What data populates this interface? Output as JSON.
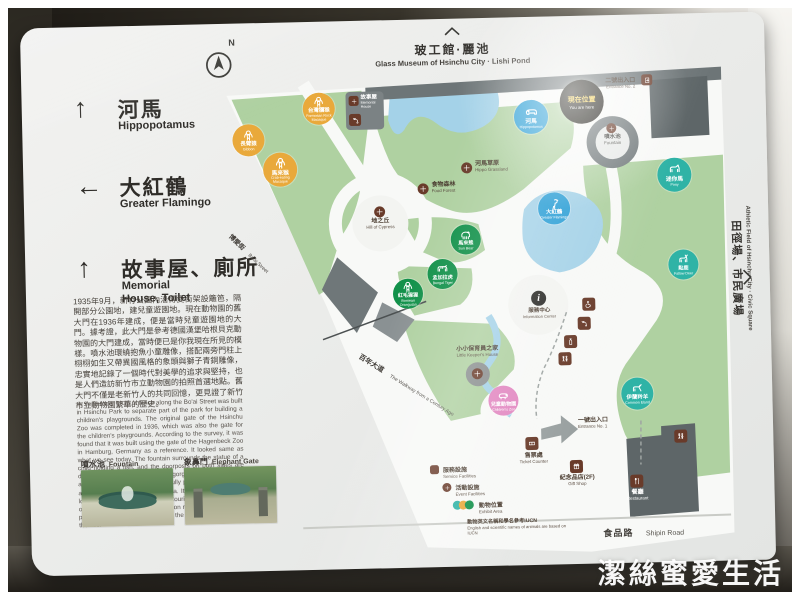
{
  "compass": {
    "label": "N"
  },
  "directions": [
    {
      "arrow": "↑",
      "zh": "河馬",
      "en": "Hippopotamus"
    },
    {
      "arrow": "←",
      "zh": "大紅鶴",
      "en": "Greater Flamingo"
    },
    {
      "arrow": "↑",
      "zh": "故事屋、廁所",
      "en": "Memorial House, Toilet"
    }
  ],
  "destinations": {
    "top": {
      "zh": "玻工館·麗池",
      "en": "Glass Museum of Hsinchu City · Lishi Pond"
    },
    "right": {
      "zh": "田徑場、市民廣場",
      "en": "Athletic Field of Hsinchu City · Civic Square"
    }
  },
  "you_are_here": {
    "zh": "現在位置",
    "en": "You are here"
  },
  "entrances": {
    "no1": {
      "zh": "一號出入口",
      "en": "Entrance No. 1"
    },
    "no2": {
      "zh": "二號出入口",
      "en": "Entrance No. 2"
    }
  },
  "info_center": {
    "zh": "服務中心",
    "en": "Information Center"
  },
  "memorial_house": {
    "zh": "故事屋",
    "en": "Memorial House"
  },
  "facilities": {
    "ticket": {
      "zh": "售票處",
      "en": "Ticket Counter"
    },
    "gift": {
      "zh": "紀念品店(2F)",
      "en": "Gift Shop"
    },
    "restaurant": {
      "zh": "餐廳",
      "en": "Restaurant"
    }
  },
  "events": {
    "grassland": {
      "zh": "河馬草原",
      "en": "Hippo Grassland"
    },
    "forest": {
      "zh": "食物森林",
      "en": "Food Forest"
    },
    "hill": {
      "zh": "地之丘",
      "en": "Hill of Cypress"
    },
    "keeper": {
      "zh": "小小保育員之家",
      "en": "Little Keeper's House"
    },
    "fountain": {
      "zh": "噴水池",
      "en": "Fountain"
    }
  },
  "streets": {
    "walkway": {
      "zh": "百年大道",
      "en": "The Walkway from a Century Ago"
    },
    "boai": {
      "zh": "博愛街",
      "en": "Bo'ai Street"
    },
    "shipin": {
      "zh": "食品路",
      "en": "Shipin Road"
    }
  },
  "map_markers": [
    {
      "id": "gibbon",
      "x": 226,
      "y": 117,
      "r": 16,
      "color": "yellow",
      "icon": "monkey",
      "zh": "長臂猿",
      "en": "Gibbon"
    },
    {
      "id": "crab-eating-macaque",
      "x": 257,
      "y": 147,
      "r": 17,
      "color": "yellow",
      "icon": "monkey",
      "zh": "馬來猴",
      "en": "Crab-eating Macaque"
    },
    {
      "id": "formosan-rock-macaque",
      "x": 297,
      "y": 87,
      "r": 16,
      "color": "yellow",
      "icon": "monkey",
      "zh": "台灣獼猴",
      "en": "Formosan Rock Macaque"
    },
    {
      "id": "hippopotamus",
      "x": 509,
      "y": 100,
      "r": 17,
      "color": "blue",
      "icon": "hippo",
      "zh": "河馬",
      "en": "Hippopotamus"
    },
    {
      "id": "greater-flamingo",
      "x": 530,
      "y": 192,
      "r": 16,
      "color": "blue",
      "icon": "flamingo",
      "zh": "大紅鶴",
      "en": "Greater Flamingo"
    },
    {
      "id": "sun-bear",
      "x": 441,
      "y": 221,
      "r": 15,
      "color": "green",
      "icon": "bear",
      "zh": "馬來熊",
      "en": "Sun Bear"
    },
    {
      "id": "bengal-tiger",
      "x": 417,
      "y": 255,
      "r": 15,
      "color": "green",
      "icon": "tiger",
      "zh": "孟加拉虎",
      "en": "Bengal Tiger"
    },
    {
      "id": "bornean-orangutan",
      "x": 382,
      "y": 274,
      "r": 15,
      "color": "green",
      "icon": "monkey",
      "zh": "紅毛猩猩",
      "en": "Bornean Orangutan"
    },
    {
      "id": "pony",
      "x": 651,
      "y": 161,
      "r": 17,
      "color": "teal",
      "icon": "horse",
      "zh": "迷你馬",
      "en": "Pony"
    },
    {
      "id": "fallow-deer",
      "x": 658,
      "y": 251,
      "r": 15,
      "color": "teal",
      "icon": "deer",
      "zh": "黇鹿",
      "en": "Fallow Deer"
    },
    {
      "id": "common-eland",
      "x": 609,
      "y": 379,
      "r": 16,
      "color": "teal",
      "icon": "eland",
      "zh": "伊蘭羚羊",
      "en": "Common Eland"
    },
    {
      "id": "childrens-zoo",
      "x": 475,
      "y": 383,
      "r": 15,
      "color": "pink",
      "icon": "capybara",
      "zh": "兒童動物園",
      "en": "Children's Zoo"
    }
  ],
  "service_points": [
    {
      "id": "accessible-toilet",
      "x": 556,
      "y": 282,
      "icon": "wheelchair"
    },
    {
      "id": "nursing-room",
      "x": 551,
      "y": 301,
      "icon": "faucet"
    },
    {
      "id": "drinking-fountain",
      "x": 537,
      "y": 319,
      "icon": "bottle"
    },
    {
      "id": "toilet-center",
      "x": 531,
      "y": 336,
      "icon": "toilet"
    },
    {
      "id": "toilet-restaurant",
      "x": 645,
      "y": 416,
      "icon": "toilet"
    }
  ],
  "legend": {
    "items": [
      {
        "zh": "服務設施",
        "en": "Service Facilities"
      },
      {
        "zh": "活動設施",
        "en": "Event Facilities"
      },
      {
        "zh": "動物位置",
        "en": "Exhibit Area"
      }
    ],
    "note_zh": "動物英文名稱和學名參考IUCN",
    "note_en": "English and scientific names of animals are based on IUCN"
  },
  "history_zh": "1935年9月，新竹公園內沿博愛街架設籬笆，隔開部分公園地，建兒童遊園地。現在動物園的舊大門在1936年建成，便是當時兒童遊園地的大門。據考證，此大門是參考德國漢堡哈根貝克動物園的大門建成，當時便已是你我現在所見的模樣。噴水池環繞抱魚小童雕像，搭配兩旁門柱上栩栩如生又帶異國風格的象頭與獅子青銅雕像，忠實地記錄了一個時代對美學的追求與堅持，也是人們造訪新竹市立動物園的拍照首選地點。舊大門不僅是老新竹人的共同回憶，更見證了新竹市立動物園繁華的歷史。",
  "history_en": "In September 1935, a fence along the Bo'ai Street was built in Hsinchu Park to separate part of the park for building a children's playgrounds. The original gate of the Hsinchu Zoo was completed in 1936, which was also the gate for the children's playgrounds. According to the survey, it was found that it was built using the gate of the Hagenbeck Zoo in Hamburg, Germany as a reference. It looked same as what we see today. The fountain surrounds the statue of a child holding a fish, and the doorposts on both sides are decorated with bronze statues of gorgeous elephant heads and lions. These structures faithfully present the advocacy and pursuit of aesthetics in an era. It is also the preferred location for photographing when tourists visit the zoo. The original gate is not only the common memory of many local people but also the eyewitness of the prosperous history of the zoo.",
  "photos": [
    {
      "zh": "噴水池",
      "en": "Fountain"
    },
    {
      "zh": "象鼻門",
      "en": "Elephant Gate"
    }
  ],
  "watermark": "潔絲蜜愛生活"
}
